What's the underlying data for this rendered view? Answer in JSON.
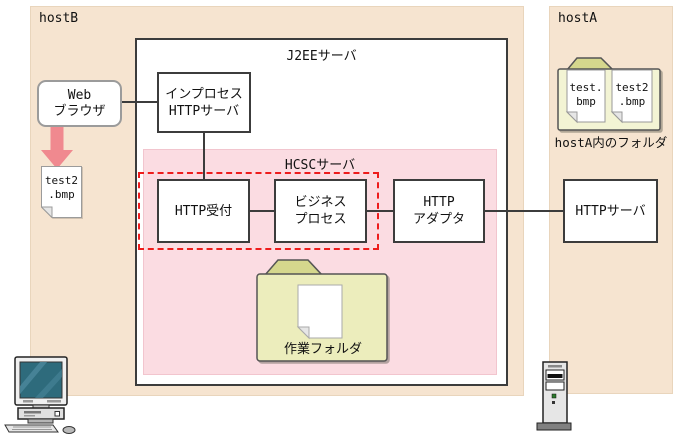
{
  "hosts": {
    "host_b": {
      "label": "hostB"
    },
    "host_a": {
      "label": "hostA"
    }
  },
  "j2ee": {
    "title": "J2EEサーバ"
  },
  "hcsc": {
    "title": "HCSCサーバ"
  },
  "nodes": {
    "web_browser": {
      "line1": "Web",
      "line2": "ブラウザ"
    },
    "inprocess": {
      "line1": "インプロセス",
      "line2": "HTTPサーバ"
    },
    "http_reception": {
      "label": "HTTP受付"
    },
    "business_process": {
      "line1": "ビジネス",
      "line2": "プロセス"
    },
    "http_adapter": {
      "line1": "HTTP",
      "line2": "アダプタ"
    },
    "http_server": {
      "label": "HTTPサーバ"
    }
  },
  "work_folder": {
    "label": "作業フォルダ"
  },
  "hosta_folder": {
    "caption": "hostA内のフォルダ",
    "file1": {
      "line1": "test.",
      "line2": "bmp"
    },
    "file2": {
      "line1": "test2",
      "line2": ".bmp"
    }
  },
  "downloaded_file": {
    "line1": "test2",
    "line2": ".bmp"
  },
  "colors": {
    "host_area": "#f6e4d0",
    "hcsc_area": "#fbdce2",
    "scope_border": "#ee1c1c",
    "download_arrow": "#f0898f",
    "folder_tab": "#d5d78d",
    "work_folder_body": "#ecedbc",
    "hosta_folder_body": "#f3f4d4",
    "monitor_screen": "#2e6b7c"
  }
}
